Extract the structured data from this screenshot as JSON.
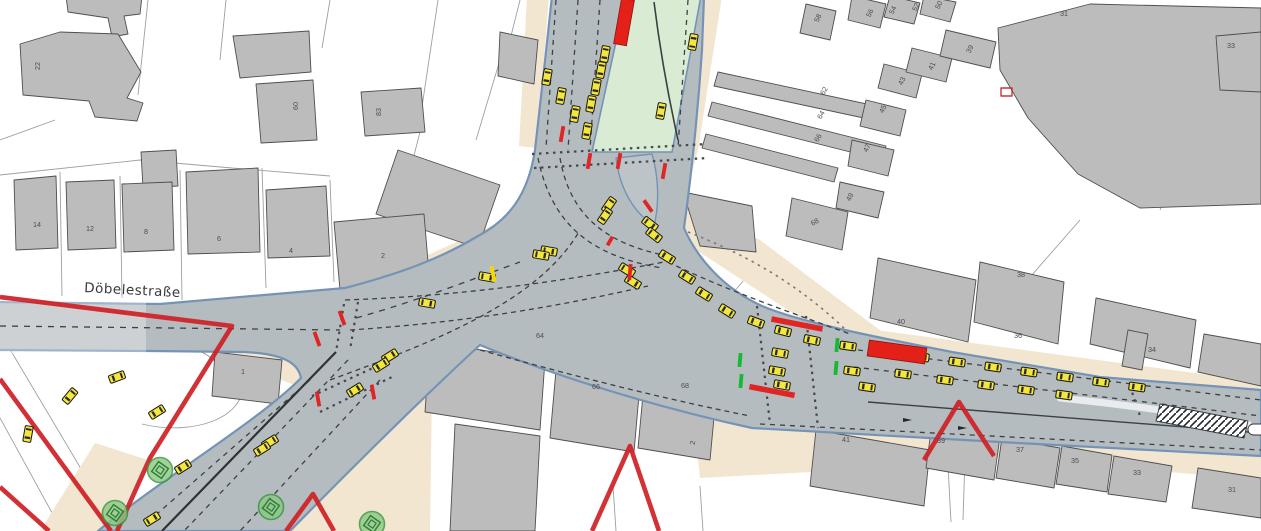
{
  "meta": {
    "view": "traffic-microsimulation-map",
    "canvas_width": 1261,
    "canvas_height": 531
  },
  "street_label": {
    "text": "Döbelestraße",
    "x": 84,
    "y": 292,
    "rotation": 3
  },
  "colors": {
    "road": "#b5bcc0",
    "road_edge": "#7493b6",
    "building": "#bcbcbc",
    "building_outline": "#4f4f4f",
    "parcel_line": "#9aa0a4",
    "sidewalk": "#f2e6d0",
    "green_area": "#d9ecd3",
    "car": "#f3e63c",
    "bus_red": "#e32119",
    "signal_red": "#e02525",
    "signal_green": "#17b832",
    "signal_amber": "#f5d800",
    "construction": "#cf2127",
    "tree": "#8cc984",
    "label": "#4c4c50"
  },
  "vehicles": {
    "cars": [
      [
        547,
        77,
        100
      ],
      [
        561,
        96,
        100
      ],
      [
        575,
        114,
        100
      ],
      [
        587,
        131,
        100
      ],
      [
        605,
        54,
        100
      ],
      [
        601,
        70,
        100
      ],
      [
        596,
        87,
        100
      ],
      [
        591,
        104,
        100
      ],
      [
        693,
        42,
        -80
      ],
      [
        661,
        111,
        -80
      ],
      [
        609,
        205,
        125
      ],
      [
        605,
        216,
        125
      ],
      [
        650,
        224,
        38
      ],
      [
        654,
        235,
        38
      ],
      [
        549,
        251,
        10
      ],
      [
        541,
        255,
        10
      ],
      [
        627,
        270,
        32
      ],
      [
        633,
        282,
        32
      ],
      [
        427,
        303,
        10
      ],
      [
        487,
        277,
        10
      ],
      [
        390,
        356,
        -32
      ],
      [
        381,
        365,
        148
      ],
      [
        355,
        390,
        -32
      ],
      [
        270,
        442,
        148
      ],
      [
        262,
        449,
        148
      ],
      [
        157,
        412,
        148
      ],
      [
        183,
        467,
        148
      ],
      [
        152,
        519,
        -32
      ],
      [
        117,
        377,
        160
      ],
      [
        70,
        396,
        130
      ],
      [
        28,
        434,
        100
      ],
      [
        667,
        257,
        212
      ],
      [
        687,
        277,
        212
      ],
      [
        704,
        294,
        212
      ],
      [
        727,
        311,
        212
      ],
      [
        756,
        322,
        200
      ],
      [
        783,
        331,
        194
      ],
      [
        812,
        340,
        192
      ],
      [
        780,
        353,
        190
      ],
      [
        777,
        371,
        190
      ],
      [
        782,
        385,
        190
      ],
      [
        848,
        346,
        188
      ],
      [
        852,
        371,
        188
      ],
      [
        867,
        387,
        188
      ],
      [
        886,
        351,
        188
      ],
      [
        921,
        357,
        188
      ],
      [
        957,
        362,
        188
      ],
      [
        993,
        367,
        188
      ],
      [
        1029,
        372,
        188
      ],
      [
        1065,
        377,
        188
      ],
      [
        1101,
        382,
        188
      ],
      [
        1137,
        387,
        188
      ],
      [
        903,
        374,
        188
      ],
      [
        945,
        380,
        188
      ],
      [
        986,
        385,
        188
      ],
      [
        1026,
        390,
        188
      ],
      [
        1064,
        395,
        188
      ]
    ],
    "buses": [
      [
        624,
        22,
        46,
        13,
        100
      ],
      [
        897,
        352,
        58,
        16,
        8
      ]
    ]
  },
  "signals": {
    "red": [
      [
        562,
        134,
        16,
        100
      ],
      [
        589,
        161,
        16,
        100
      ],
      [
        619,
        161,
        16,
        100
      ],
      [
        664,
        171,
        16,
        100
      ],
      [
        648,
        206,
        14,
        55
      ],
      [
        610,
        241,
        10,
        120
      ],
      [
        630,
        272,
        16,
        95
      ],
      [
        342,
        318,
        15,
        70
      ],
      [
        317,
        339,
        15,
        70
      ],
      [
        318,
        399,
        15,
        80
      ],
      [
        373,
        392,
        15,
        80
      ]
    ],
    "red_wide": [
      [
        797,
        324,
        52,
        11
      ],
      [
        772,
        391,
        46,
        11
      ]
    ],
    "amber": [
      [
        493,
        274,
        16,
        78
      ]
    ],
    "green": [
      [
        740,
        360,
        14,
        95
      ],
      [
        741,
        381,
        14,
        95
      ],
      [
        837,
        345,
        14,
        95
      ],
      [
        836,
        368,
        14,
        95
      ]
    ]
  },
  "trees": [
    [
      160,
      470
    ],
    [
      115,
      513
    ],
    [
      271,
      507
    ],
    [
      372,
      524
    ]
  ],
  "building_labels": [
    [
      "22",
      40,
      66,
      -90
    ],
    [
      "60",
      298,
      106,
      -90
    ],
    [
      "83",
      381,
      112,
      -90
    ],
    [
      "14",
      37,
      227,
      0
    ],
    [
      "12",
      90,
      231,
      0
    ],
    [
      "8",
      146,
      234,
      0
    ],
    [
      "6",
      219,
      241,
      0
    ],
    [
      "4",
      291,
      253,
      0
    ],
    [
      "2",
      383,
      258,
      0
    ],
    [
      "1",
      243,
      374,
      0
    ],
    [
      "58",
      820,
      19,
      -65
    ],
    [
      "56",
      872,
      14,
      -65
    ],
    [
      "54",
      895,
      11,
      -65
    ],
    [
      "52",
      918,
      8,
      -65
    ],
    [
      "50",
      941,
      6,
      -65
    ],
    [
      "62",
      826,
      92,
      -60
    ],
    [
      "64",
      823,
      116,
      -60
    ],
    [
      "66",
      820,
      139,
      -60
    ],
    [
      "68",
      816,
      224,
      -30
    ],
    [
      "39",
      972,
      50,
      -65
    ],
    [
      "41",
      934,
      67,
      -65
    ],
    [
      "43",
      904,
      82,
      -65
    ],
    [
      "45",
      885,
      110,
      -65
    ],
    [
      "47",
      869,
      149,
      -65
    ],
    [
      "49",
      852,
      198,
      -65
    ],
    [
      "31",
      1064,
      16,
      0
    ],
    [
      "33",
      1231,
      48,
      0
    ],
    [
      "40",
      901,
      324,
      0
    ],
    [
      "38",
      1021,
      277,
      0
    ],
    [
      "36",
      1018,
      338,
      0
    ],
    [
      "34",
      1152,
      352,
      0
    ],
    [
      "41",
      846,
      442,
      0
    ],
    [
      "39",
      941,
      443,
      0
    ],
    [
      "37",
      1020,
      452,
      0
    ],
    [
      "35",
      1075,
      463,
      0
    ],
    [
      "33",
      1137,
      475,
      0
    ],
    [
      "31",
      1232,
      492,
      0
    ],
    [
      "64",
      540,
      338,
      0
    ],
    [
      "66",
      596,
      389,
      0
    ],
    [
      "68",
      685,
      388,
      0
    ],
    [
      "2",
      695,
      443,
      -80
    ]
  ]
}
